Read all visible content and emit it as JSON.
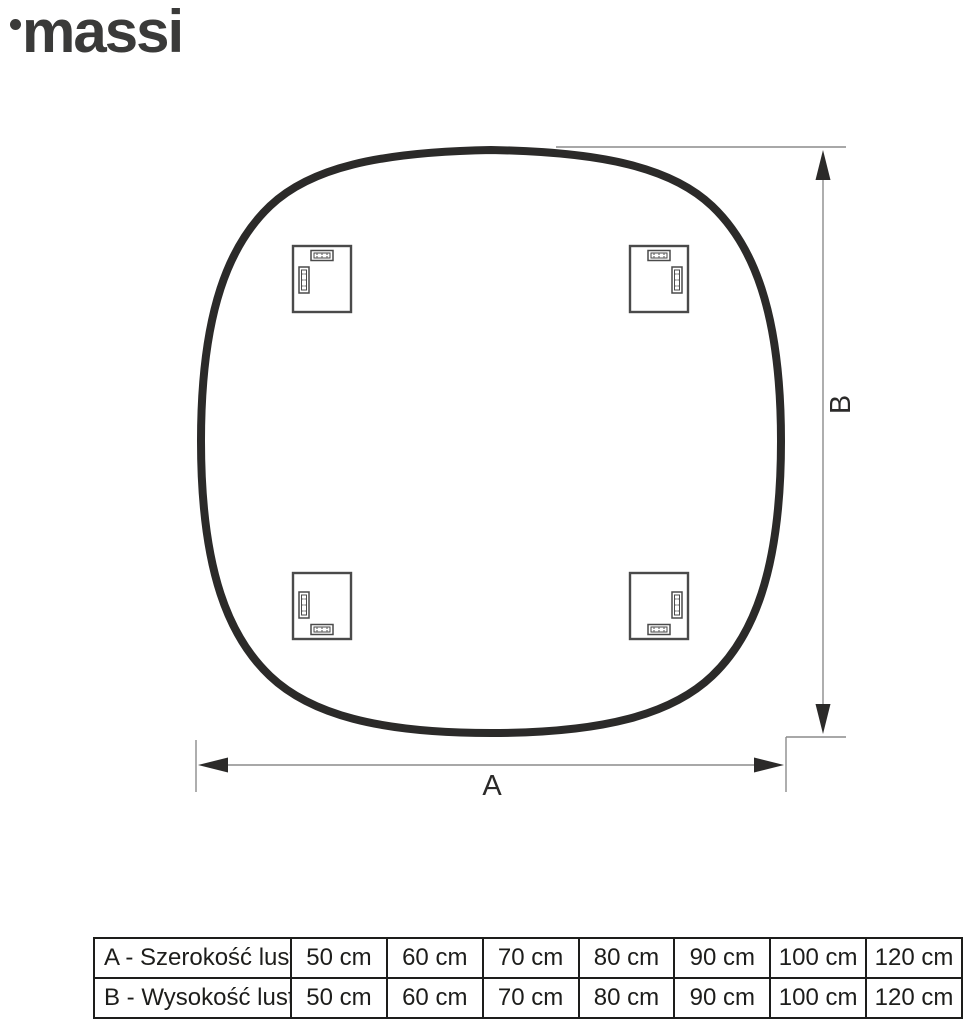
{
  "logo": {
    "text": "massi"
  },
  "diagram": {
    "label_a": "A",
    "label_b": "B"
  },
  "colors": {
    "mirror_outline": "#2b2a29",
    "bracket_stroke": "#4a4a4a",
    "dimension_line": "#8c8c8c",
    "text": "#1d1d1b",
    "logo": "#3a3a39"
  },
  "table": {
    "rows": [
      {
        "label": "A - Szerokość lustra",
        "values": [
          "50 cm",
          "60 cm",
          "70 cm",
          "80 cm",
          "90 cm",
          "100 cm",
          "120 cm"
        ]
      },
      {
        "label": "B - Wysokość lustra",
        "values": [
          "50 cm",
          "60 cm",
          "70 cm",
          "80 cm",
          "90 cm",
          "100 cm",
          "120 cm"
        ]
      }
    ]
  }
}
